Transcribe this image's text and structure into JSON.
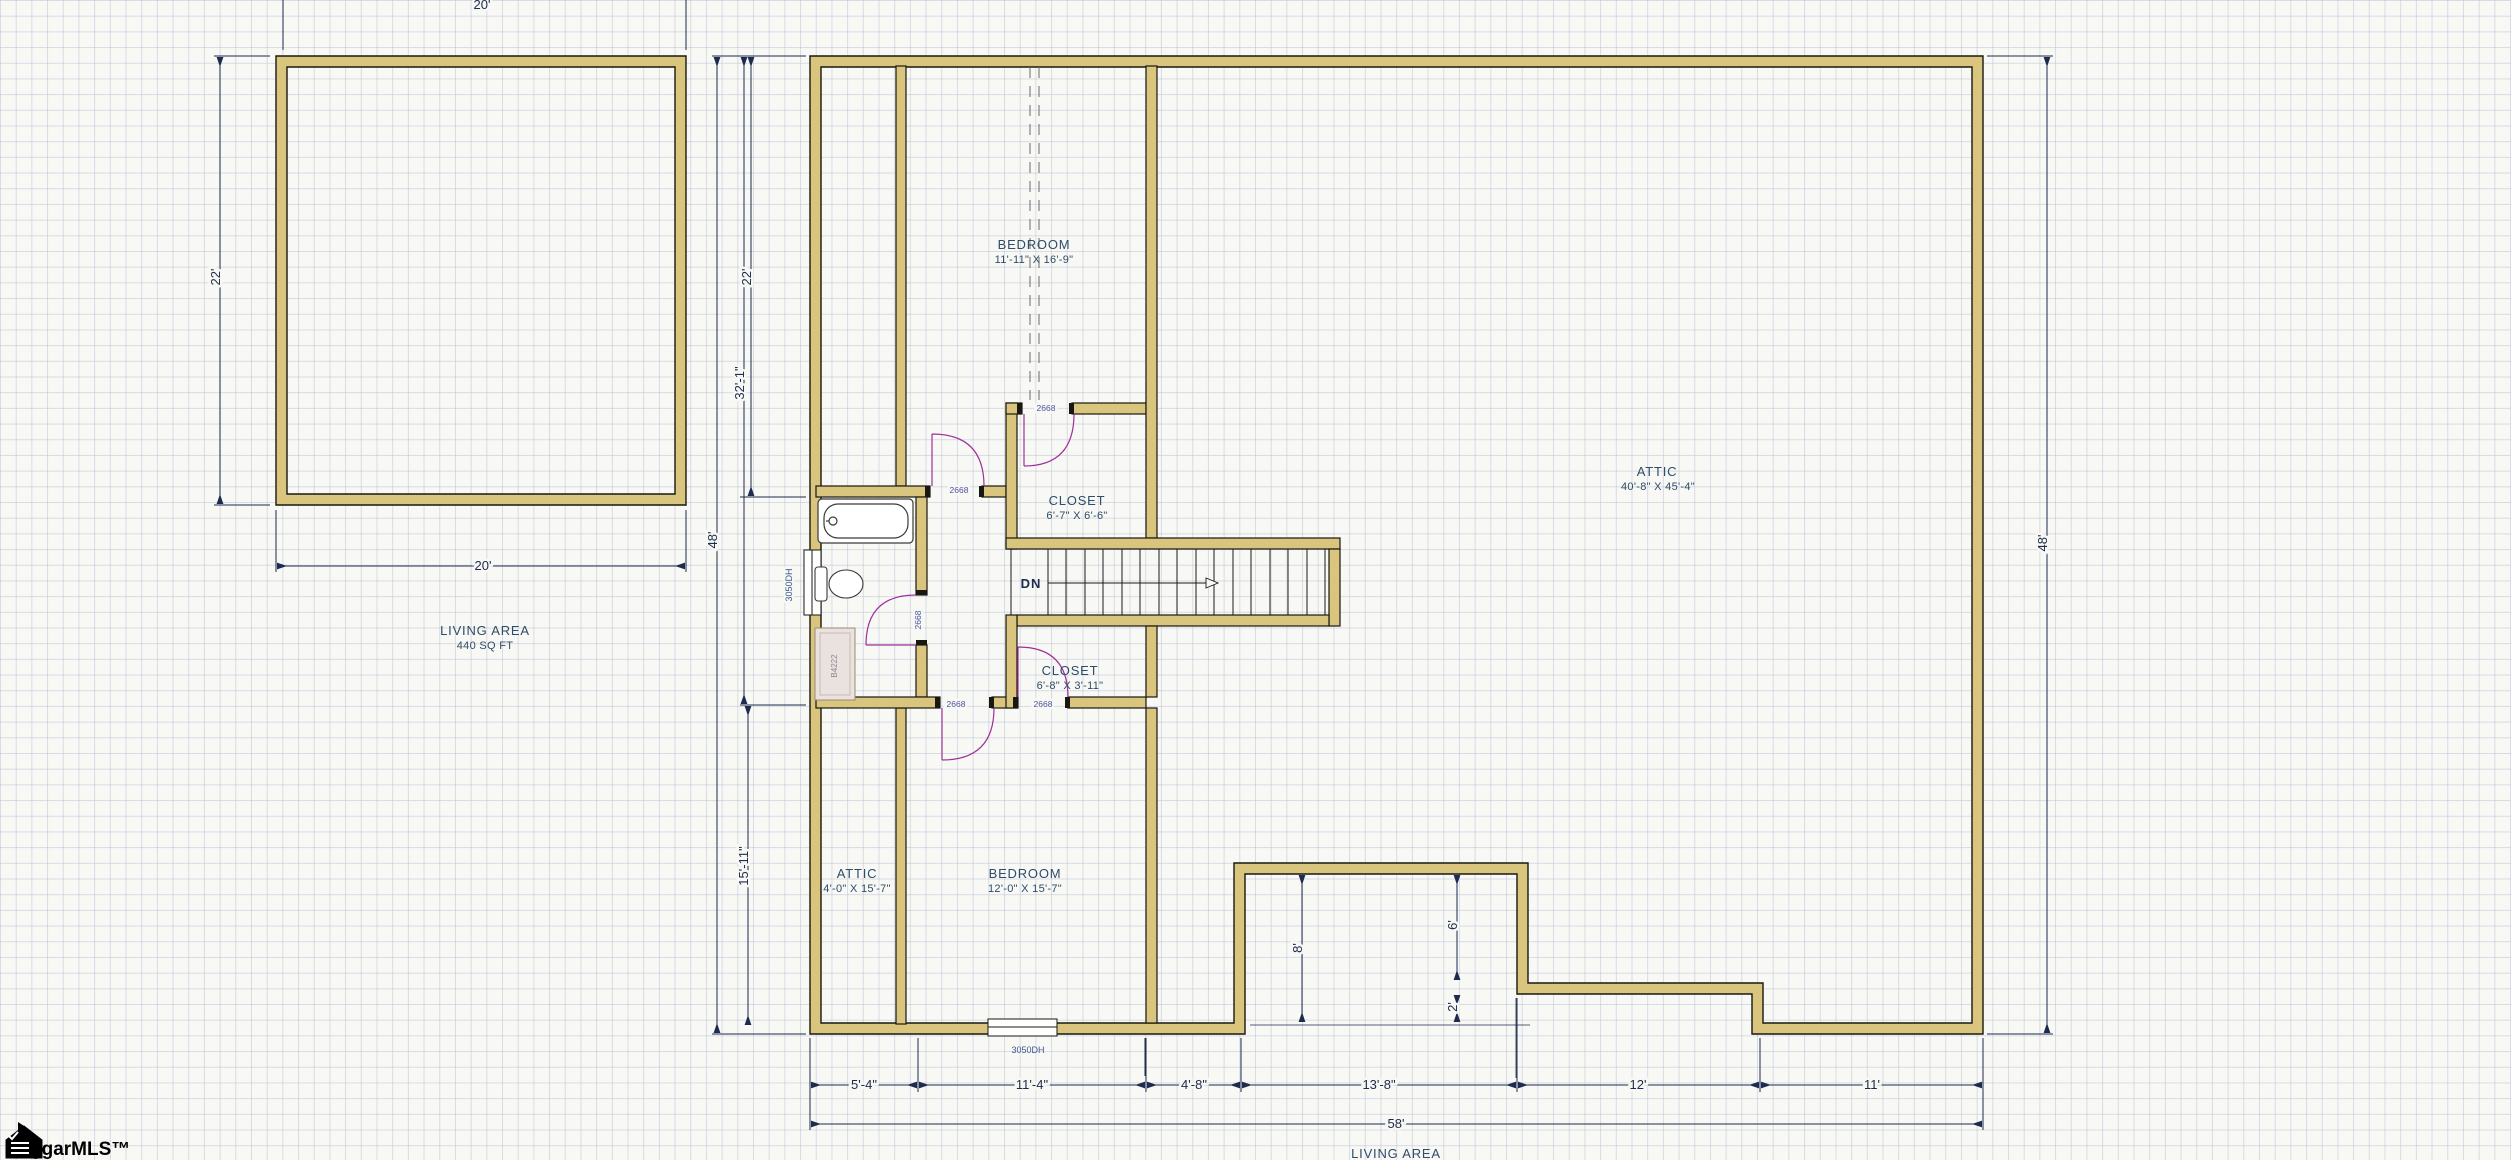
{
  "colors": {
    "background": "#f8f8f5",
    "grid_line": "#b7bed4",
    "wall_fill": "#d9c57d",
    "wall_outline": "#181810",
    "dimension_line": "#1d2b4e",
    "room_label": "#2e4d68",
    "door_swing": "#a0309a",
    "vanity_fill": "#e9e2df"
  },
  "left_unit": {
    "dim_top": "20'",
    "dim_left": "22'",
    "dim_bottom": "20'",
    "area_title": "LIVING AREA",
    "area_sqft": "440 SQ FT"
  },
  "main_unit": {
    "rooms": [
      {
        "name": "BEDROOM",
        "size": "11'-11\" X 16'-9\""
      },
      {
        "name": "CLOSET",
        "size": "6'-7\" X 6'-6\""
      },
      {
        "name": "ATTIC",
        "size": "40'-8\" X 45'-4\""
      },
      {
        "name": "CLOSET",
        "size": "6'-8\" X 3'-11\""
      },
      {
        "name": "ATTIC",
        "size": "4'-0\" X 15'-7\""
      },
      {
        "name": "BEDROOM",
        "size": "12'-0\" X 15'-7\""
      }
    ],
    "stairs_label": "DN",
    "doors": {
      "bedroom_top": "2668",
      "closet_top": "2668",
      "bathroom": "2668",
      "bedroom_bottom": "2668",
      "closet_bottom": "2668"
    },
    "windows": {
      "left": "3050DH",
      "bottom": "3050DH"
    },
    "vanity_label": "B4222",
    "dims_left": {
      "d22": "22'",
      "d32": "32'-1\"",
      "d15": "15'-11\"",
      "d48": "48'"
    },
    "dim_right": "48'",
    "dims_bottom": [
      "5'-4\"",
      "11'-4\"",
      "4'-8\"",
      "13'-8\"",
      "12'",
      "11'"
    ],
    "dim_total": "58'",
    "notch_dims": {
      "d8": "8'",
      "d6": "6'",
      "d2": "2'"
    },
    "area_title": "LIVING AREA"
  },
  "watermark": {
    "text": "ggarMLS™",
    "icon": "house-logo-icon"
  }
}
